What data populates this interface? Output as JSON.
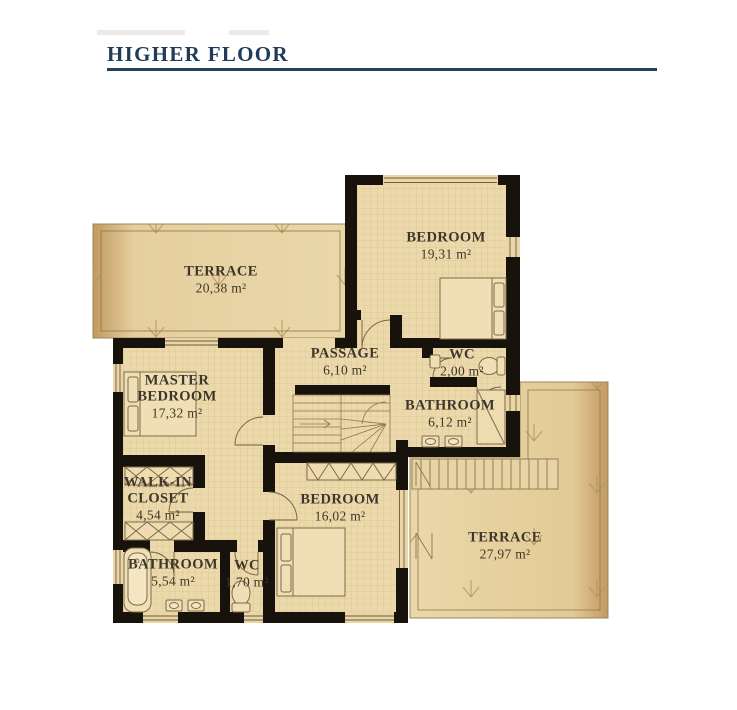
{
  "title": "HIGHER FLOOR",
  "rooms": [
    {
      "id": "terrace-left",
      "name": "TERRACE",
      "area": "20,38 m²"
    },
    {
      "id": "bedroom-top",
      "name": "BEDROOM",
      "area": "19,31 m²"
    },
    {
      "id": "passage",
      "name": "PASSAGE",
      "area": "6,10 m²"
    },
    {
      "id": "wc-top",
      "name": "WC",
      "area": "2,00 m²"
    },
    {
      "id": "bathroom-top",
      "name": "BATHROOM",
      "area": "6,12 m²"
    },
    {
      "id": "master-bedroom",
      "name": "MASTER BEDROOM",
      "area": "17,32 m²"
    },
    {
      "id": "walk-in-closet",
      "name": "WALK-IN CLOSET",
      "area": "4,54 m²"
    },
    {
      "id": "bedroom-bottom",
      "name": "BEDROOM",
      "area": "16,02 m²"
    },
    {
      "id": "bathroom-bottom",
      "name": "BATHROOM",
      "area": "5,54 m²"
    },
    {
      "id": "wc-bottom",
      "name": "WC",
      "area": "1,70 m²"
    },
    {
      "id": "terrace-right",
      "name": "TERRACE",
      "area": "27,97 m²"
    }
  ],
  "palette": {
    "title_color": "#203c58",
    "wall_color": "#17120c",
    "floor_color": "#ecd9ab",
    "terrace_color": "#e2cb9c",
    "line_color": "#8b7752",
    "label_color": "#3d362a"
  }
}
